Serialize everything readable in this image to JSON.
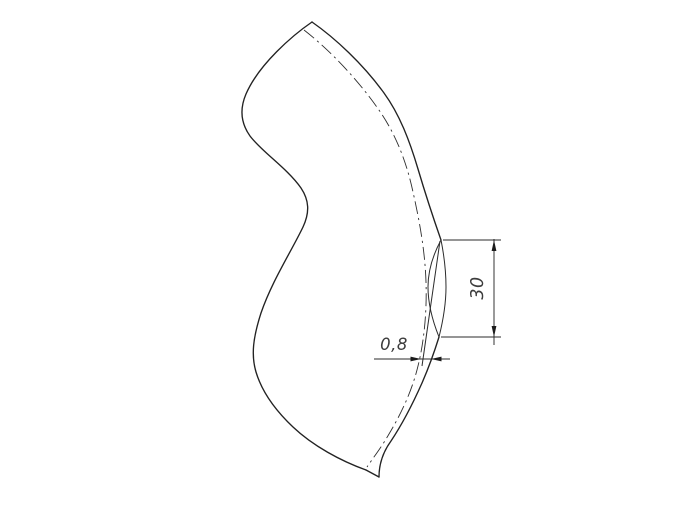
{
  "page": {
    "background_color": "#ffffff"
  },
  "drawing": {
    "kind": "technical-drawing-pipe-elbow",
    "line_color": "#222222",
    "text_color": "#3c3c3c",
    "dimensions": {
      "face_height": {
        "label": "30"
      },
      "edge_gap": {
        "label": "0,8"
      }
    }
  }
}
